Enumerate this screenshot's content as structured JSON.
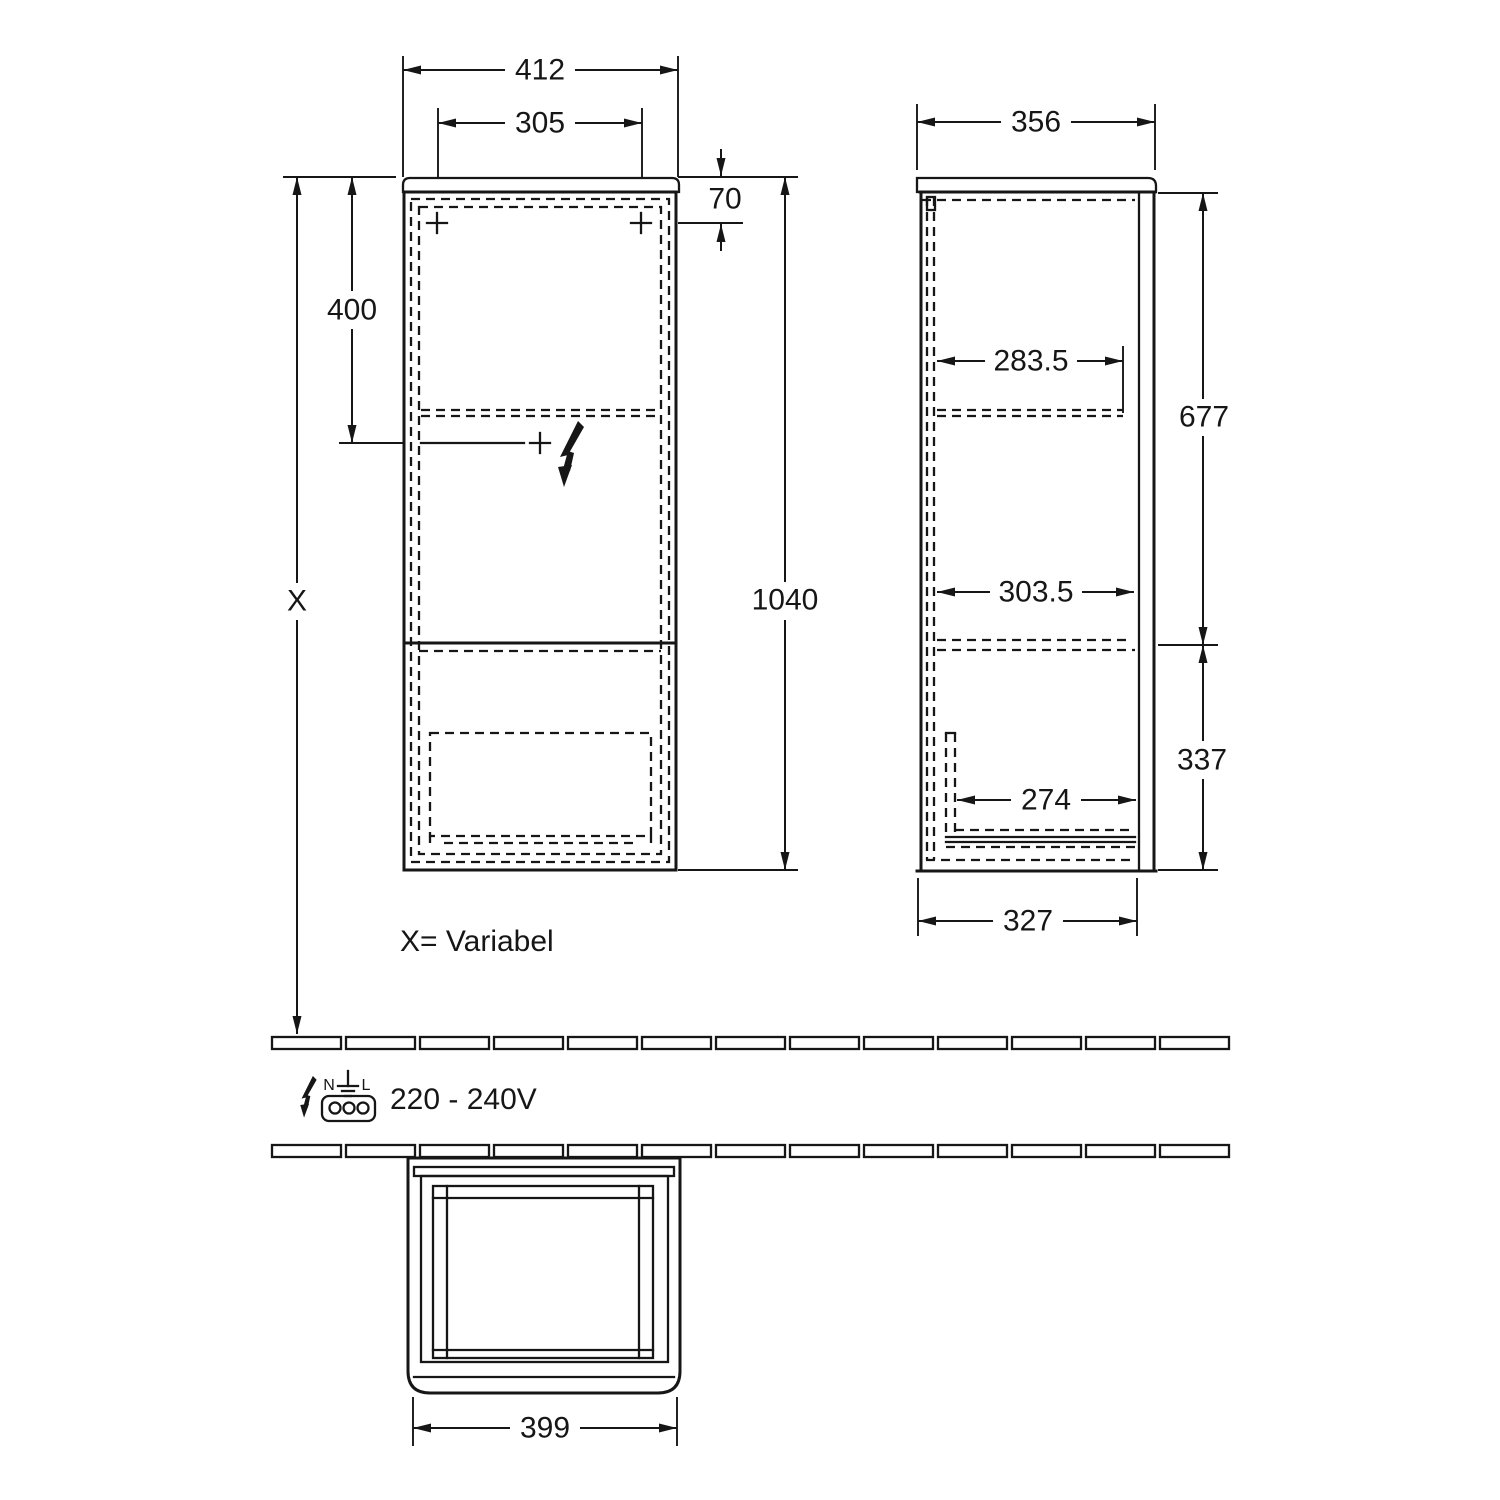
{
  "front_view": {
    "width": "412",
    "inner_width": "305",
    "top_panel_height": "70",
    "upper_section_height": "400",
    "total_height": "1040",
    "wall_height": "X"
  },
  "side_view": {
    "depth": "356",
    "upper_shelf_depth": "283.5",
    "upper_height": "677",
    "middle_shelf_depth": "303.5",
    "lower_shelf_depth": "274",
    "lower_height": "337",
    "base_depth": "327"
  },
  "top_view": {
    "width": "399"
  },
  "notes": {
    "variable": "X= Variabel"
  },
  "power": {
    "voltage": "220 - 240V",
    "neutral_label": "N",
    "line_label": "L"
  },
  "colors": {
    "line": "#161616",
    "background": "#ffffff"
  }
}
